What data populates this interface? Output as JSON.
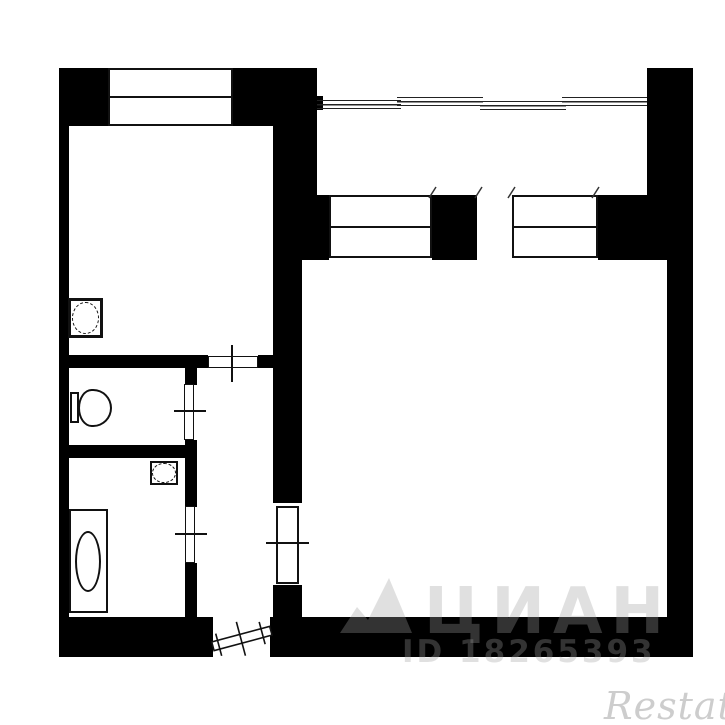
{
  "colors": {
    "background": "#ffffff",
    "wall": "#000000",
    "line": "#111111",
    "watermark_gray": "rgba(160,160,160,0.32)",
    "restate_gray": "#cdcdcd"
  },
  "watermarks": {
    "cian_text": "Циан",
    "cian_id": "ID 18265393",
    "restate_text": "Restate",
    "cian_logo_icon": "cian-peaks-logo-icon"
  },
  "plan": {
    "rooms": [
      "kitchen",
      "wc",
      "bathroom",
      "hallway",
      "living-room",
      "balcony"
    ],
    "fixtures": [
      "kitchen-sink-icon",
      "toilet-icon",
      "bathroom-sink-icon",
      "bathtub-icon"
    ],
    "windows": [
      "kitchen-window",
      "balcony-window-left",
      "balcony-window-right"
    ],
    "doors": [
      "kitchen-door",
      "wc-door",
      "bathroom-door",
      "living-room-door",
      "balcony-door-opening",
      "entrance-door"
    ]
  }
}
